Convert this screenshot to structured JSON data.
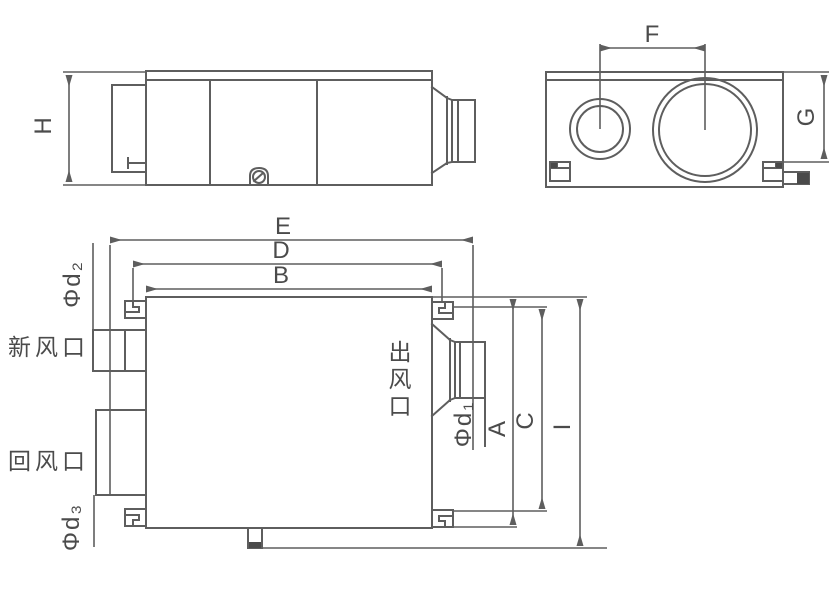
{
  "colors": {
    "background": "#ffffff",
    "line": "#5e5e5e",
    "text": "#4b4b4b",
    "dark_fill": "#4a4a4a"
  },
  "side_view": {
    "height_dim": "H"
  },
  "end_view": {
    "port_spacing_dim": "F",
    "height_dim": "G"
  },
  "plan_view": {
    "top_dims": {
      "outer": "E",
      "middle": "D",
      "inner": "B"
    },
    "right_dims": {
      "inner": "A",
      "middle": "C",
      "outer": "I"
    },
    "ports": {
      "fresh_air": {
        "label": "新风口",
        "diameter": "Φd₂"
      },
      "return_air": {
        "label": "回风口",
        "diameter": "Φd₃"
      },
      "outlet": {
        "chars": [
          "出",
          "风",
          "口"
        ],
        "diameter": "Φd₁"
      }
    }
  }
}
